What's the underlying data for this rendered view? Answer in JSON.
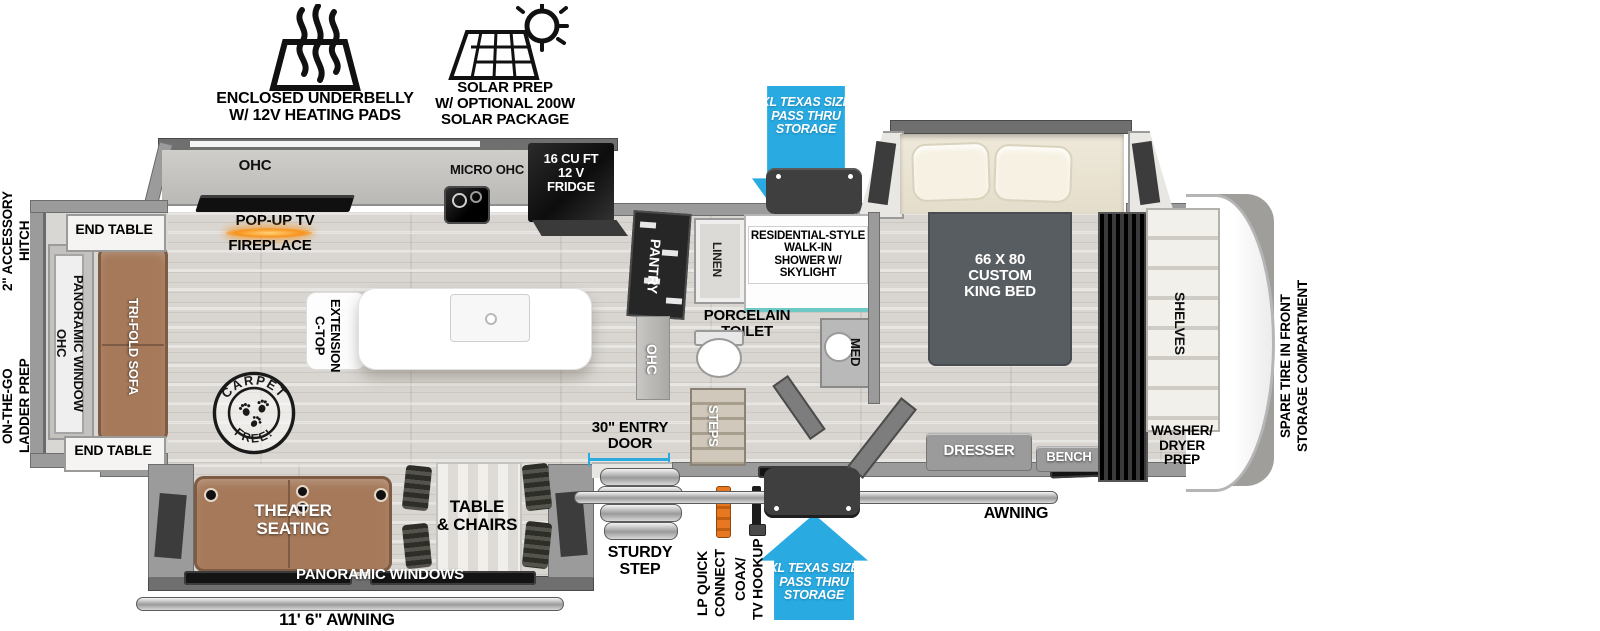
{
  "palette": {
    "accent_blue": "#29abe2",
    "fireplace_orange": "#f7941d",
    "sofa_brown": "#a5795a",
    "appliance_black": "#141414",
    "wall_gray": "#9b9b9b",
    "shower_teal": "#6ec9c4"
  },
  "badges": {
    "underbelly_label": "ENCLOSED UNDERBELLY\nW/ 12V HEATING PADS",
    "solar_label": "SOLAR PREP\nW/ OPTIONAL 200W\nSOLAR PACKAGE"
  },
  "callouts": {
    "pass_thru_top": "XL TEXAS SIZE\nPASS THRU\nSTORAGE",
    "pass_thru_bottom": "XL TEXAS SIZE\nPASS THRU\nSTORAGE"
  },
  "exterior": {
    "accessory_hitch": "2\" ACCESSORY\nHITCH",
    "ladder_prep": "ON-THE-GO\nLADDER PREP",
    "spare_tire": "SPARE TIRE IN FRONT\nSTORAGE COMPARTMENT",
    "entry_door": "30\" ENTRY\nDOOR",
    "sturdy_step": "STURDY\nSTEP",
    "lp_quick_connect": "LP QUICK\nCONNECT",
    "coax_tv_hookup": "COAX/\nTV HOOKUP",
    "awning_side": "AWNING",
    "awning_rear": "11' 6\" AWNING"
  },
  "living": {
    "end_table_top": "END TABLE",
    "end_table_bottom": "END TABLE",
    "ohc_panoramic_window": "OHC\nPANORAMIC WINDOW",
    "tri_fold_sofa": "TRI-FOLD SOFA",
    "theater_seating": "THEATER\nSEATING",
    "table_chairs": "TABLE\n& CHAIRS",
    "panoramic_windows": "PANORAMIC WINDOWS",
    "carpet_stamp_top": "CARPET",
    "carpet_stamp_bottom": "FREE!"
  },
  "kitchen": {
    "ohc": "OHC",
    "pop_up_tv": "POP-UP TV",
    "fireplace": "FIREPLACE",
    "micro_ohc": "MICRO  OHC",
    "fridge": "16 CU FT\n12 V\nFRIDGE",
    "ctop_extension": "C-TOP\nEXTENSION"
  },
  "bath": {
    "pantry": "PANTRY",
    "ohc": "OHC",
    "linen": "LINEN",
    "shower": "RESIDENTIAL-STYLE\nWALK-IN\nSHOWER W/\nSKYLIGHT",
    "toilet": "PORCELAIN\nTOILET",
    "med": "MED",
    "steps": "STEPS"
  },
  "bedroom": {
    "king_bed": "66 X 80\nCUSTOM\nKING BED",
    "dresser": "DRESSER",
    "bench": "BENCH",
    "shelves": "SHELVES",
    "washer_dryer": "WASHER/\nDRYER\nPREP"
  }
}
